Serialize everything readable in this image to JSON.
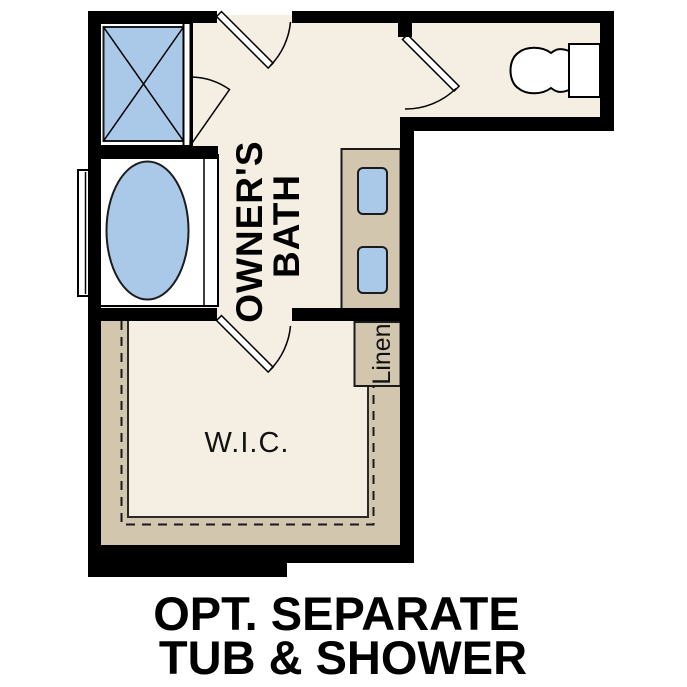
{
  "caption": {
    "line1": "OPT. SEPARATE",
    "line2": "TUB & SHOWER"
  },
  "rooms": {
    "owners_bath": {
      "name": "Owner's Bath",
      "label_line1": "OWNER'S",
      "label_line2": "BATH"
    },
    "wic": {
      "name": "Walk-In Closet",
      "label": "W.I.C."
    },
    "linen": {
      "name": "Linen Closet",
      "label": "Linen"
    }
  },
  "fixtures": {
    "shower": "shower-icon (glass enclosure with X cross)",
    "tub": "tub-icon (oval drop-in tub on deck)",
    "toilet": "toilet-icon (tank and bowl)",
    "vanity": "vanity with two sink-icons",
    "window": "window-icon (left wall by tub)",
    "doors": [
      "bath-entry-door swing",
      "shower-door swing",
      "toilet-door swing",
      "wic-door swing"
    ]
  },
  "colors": {
    "floor": "#f5eee2",
    "casework": "#d2c6af",
    "fixture": "#aac9e9",
    "wall": "#000000",
    "page": "#ffffff"
  }
}
